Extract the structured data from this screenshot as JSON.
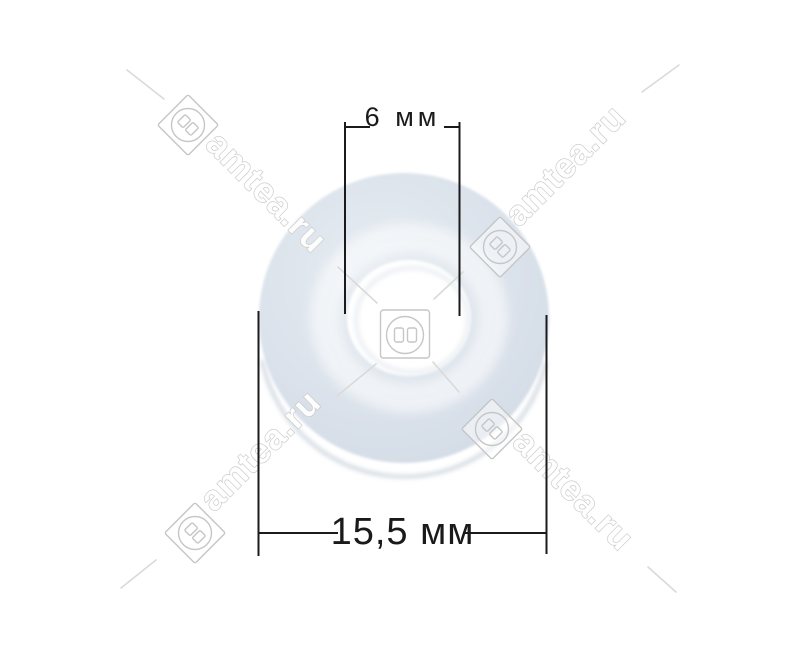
{
  "annotations": {
    "inner_diameter_label": "6 мм",
    "outer_diameter_label": "15,5 мм"
  },
  "watermark": {
    "text": "amtea.ru",
    "icon": "power-socket-icon"
  },
  "colors": {
    "background": "#ffffff",
    "washer_face": "#dde4ec",
    "washer_edge": "#c2ccd7",
    "dimension_line": "#1b1b1b",
    "watermark_outline": "#c6c6c6",
    "label_text": "#1a1a1a"
  }
}
